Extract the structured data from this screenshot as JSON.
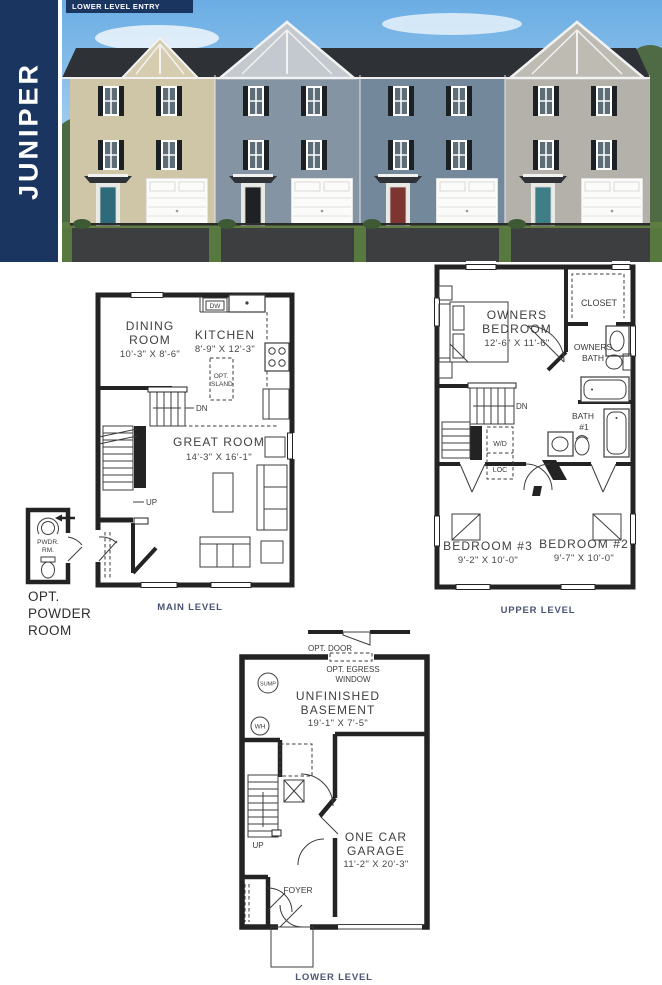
{
  "colors": {
    "navy": "#1a3560",
    "level_label": "#4a5475",
    "plan_line": "#262626"
  },
  "header": {
    "model_name": "JUNIPER",
    "banner": "LOWER LEVEL ENTRY"
  },
  "main_level": {
    "caption": "MAIN LEVEL",
    "dining_name_1": "DINING",
    "dining_name_2": "ROOM",
    "dining_dims": "10'-3\" X 8'-6\"",
    "kitchen_name": "KITCHEN",
    "kitchen_dims": "8'-9\" X 12'-3\"",
    "island_1": "OPT.",
    "island_2": "ISLAND",
    "great_name": "GREAT ROOM",
    "great_dims": "14'-3\" X 16'-1\"",
    "dw": "DW",
    "dn": "DN",
    "up": "UP"
  },
  "powder_room": {
    "label_1": "PWDR.",
    "label_2": "RM.",
    "caption_1": "OPT.",
    "caption_2": "POWDER",
    "caption_3": "ROOM"
  },
  "upper_level": {
    "caption": "UPPER LEVEL",
    "owners_1": "OWNERS",
    "owners_2": "BEDROOM",
    "owners_dims": "12'-6\" X 11'-6\"",
    "closet": "CLOSET",
    "owners_bath_1": "OWNERS",
    "owners_bath_2": "BATH",
    "bath1_1": "BATH",
    "bath1_2": "#1",
    "bed3_name": "BEDROOM #3",
    "bed3_dims": "9'-2\" X 10'-0\"",
    "bed2_name": "BEDROOM #2",
    "bed2_dims": "9'-7\" X 10'-0\"",
    "dn": "DN",
    "wd": "W/D",
    "loc": "LOC"
  },
  "lower_level": {
    "caption": "LOWER LEVEL",
    "opt_door": "OPT. DOOR",
    "egress_1": "OPT. EGRESS",
    "egress_2": "WINDOW",
    "sump": "SUMP",
    "wh": "WH",
    "up": "UP",
    "basement_1": "UNFINISHED",
    "basement_2": "BASEMENT",
    "basement_dims": "19'-1\" X 7'-5\"",
    "garage_1": "ONE CAR",
    "garage_2": "GARAGE",
    "garage_dims": "11'-2\" X 20'-3\"",
    "foyer": "FOYER"
  }
}
